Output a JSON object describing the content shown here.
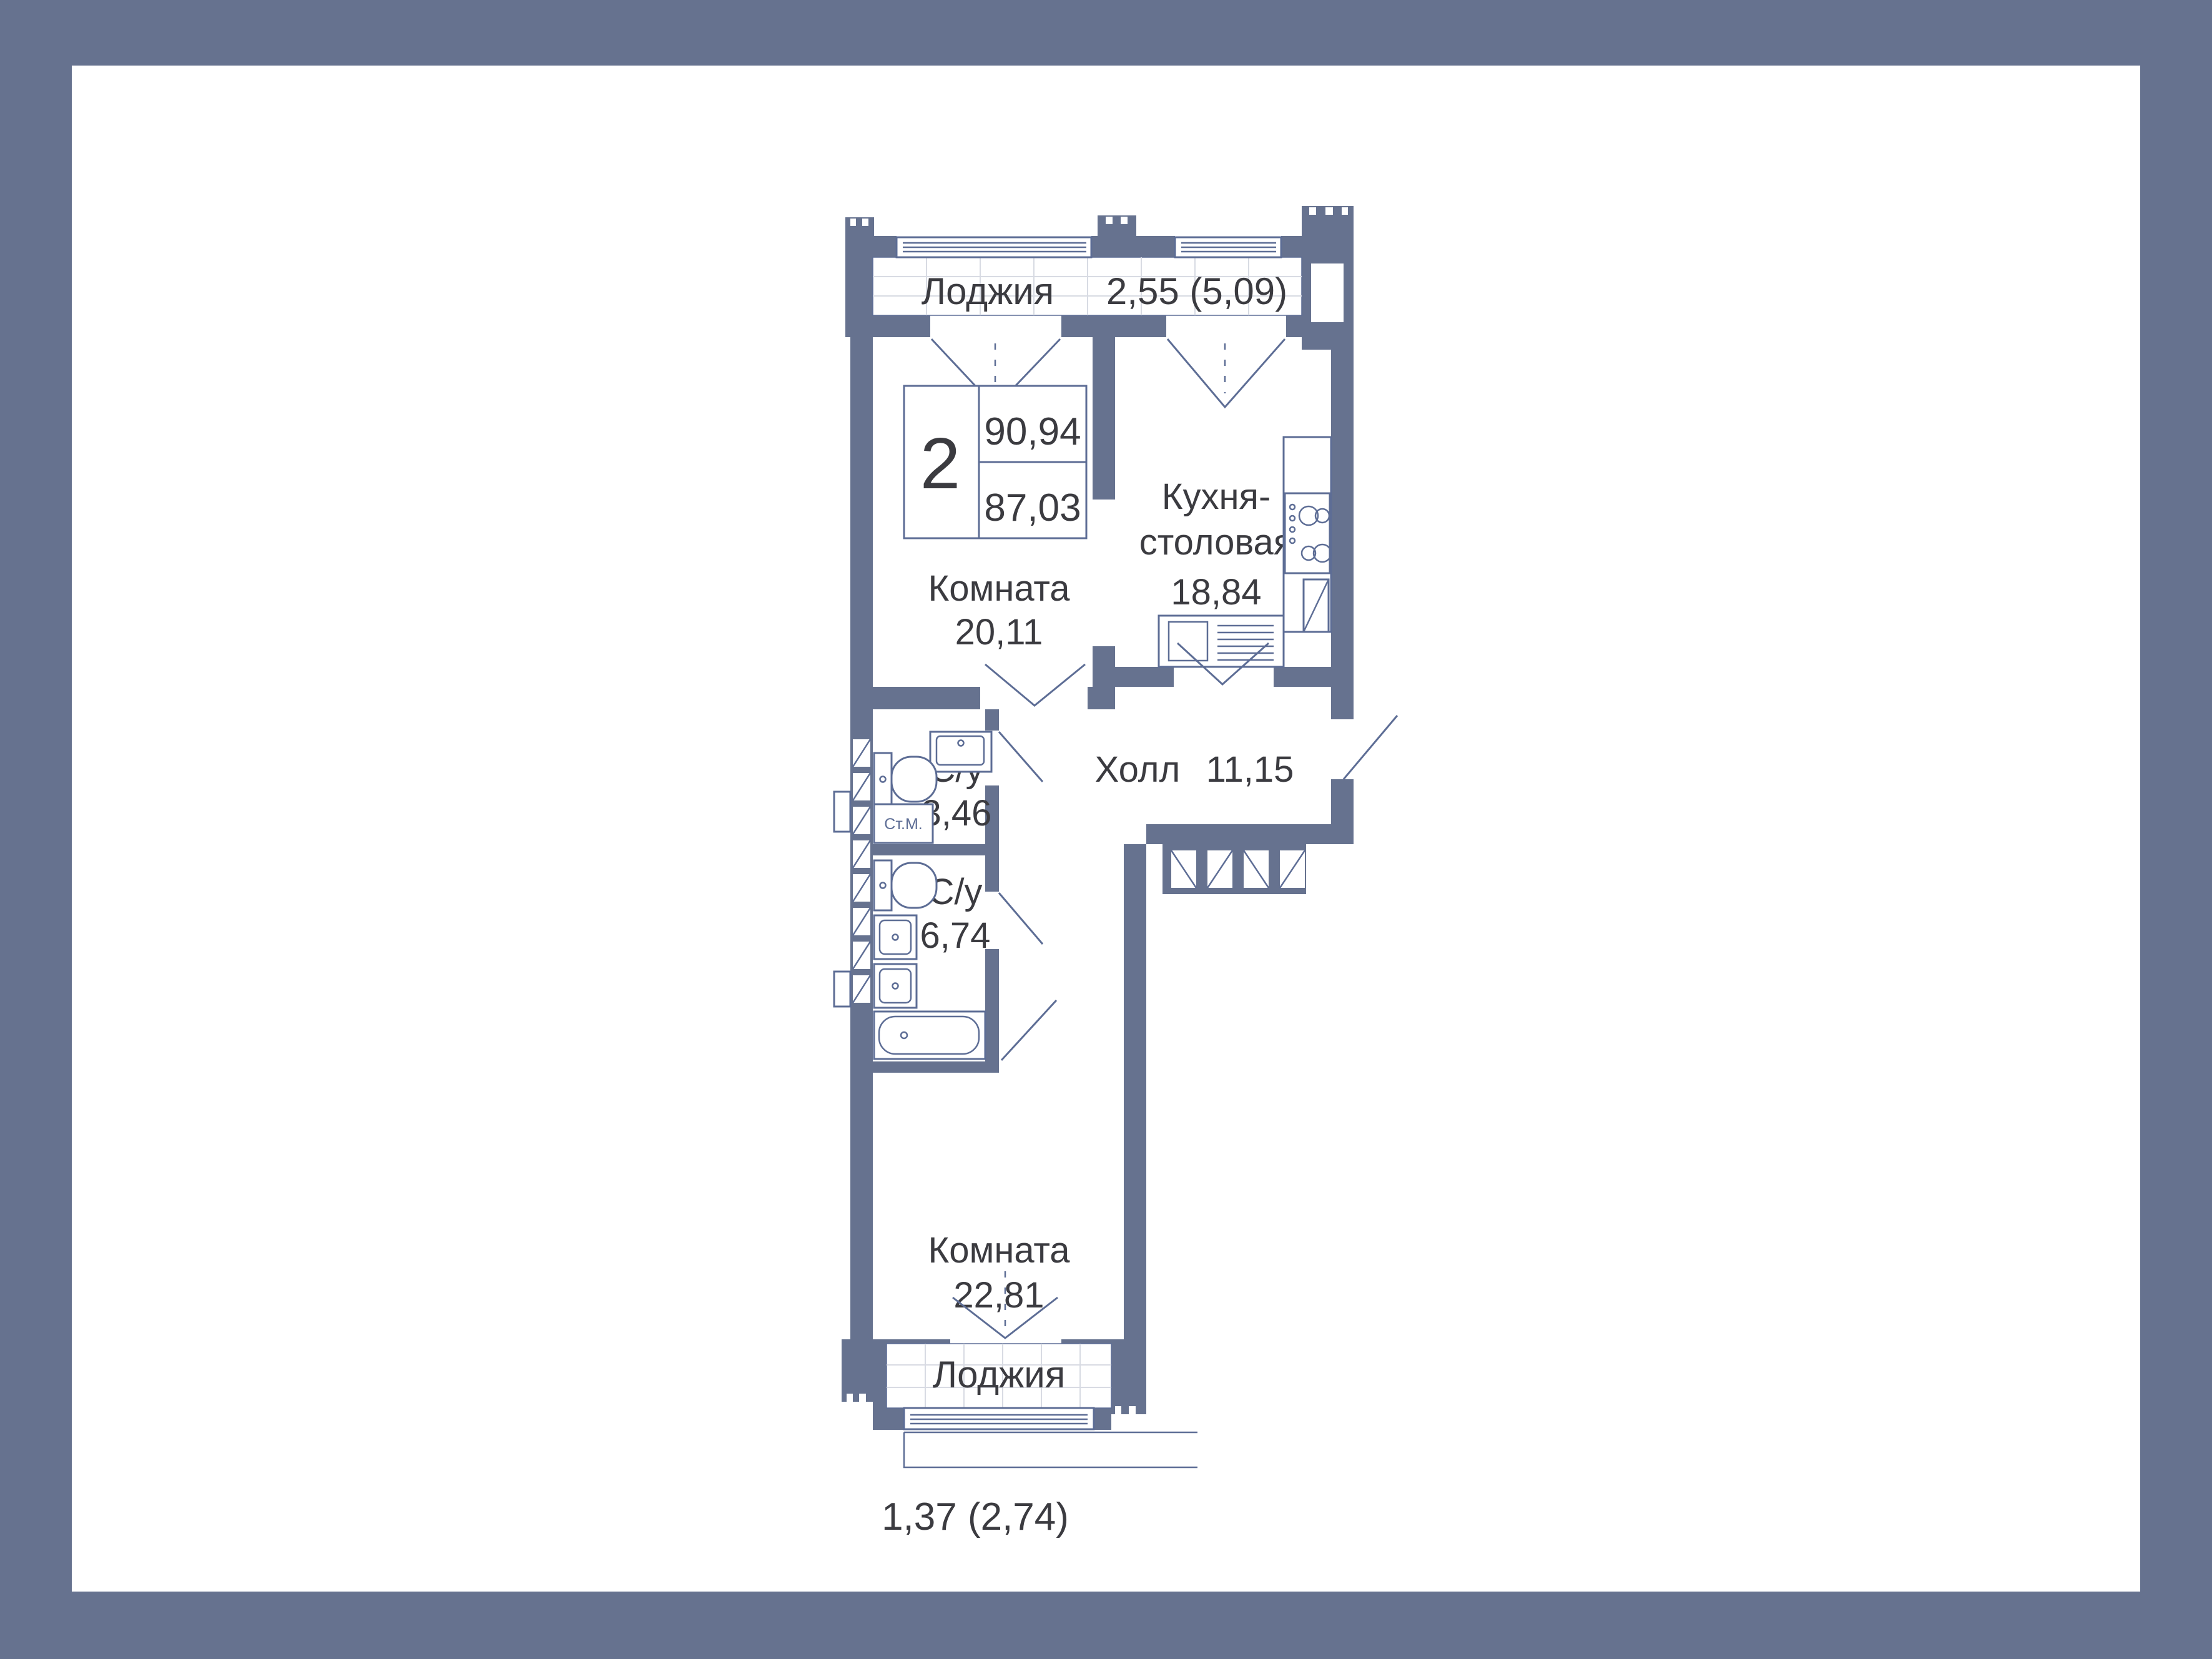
{
  "plan": {
    "loggia_top": {
      "label": "Лоджия",
      "area": "2,55 (5,09)"
    },
    "info_box": {
      "rooms": "2",
      "area_total": "90,94",
      "area_living": "87,03"
    },
    "room_top": {
      "label": "Комната",
      "area": "20,11"
    },
    "kitchen": {
      "label_line1": "Кухня-",
      "label_line2": "столовая",
      "area": "18,84"
    },
    "hall": {
      "label": "Холл",
      "area": "11,15"
    },
    "bathroom_small": {
      "label": "С/у",
      "area": "3,46"
    },
    "washing_machine": {
      "label": "Ст.М."
    },
    "bathroom_large": {
      "label": "С/у",
      "area": "6,74"
    },
    "room_bottom": {
      "label": "Комната",
      "area": "22,81"
    },
    "loggia_bottom": {
      "label": "Лоджия",
      "area": "1,37 (2,74)"
    },
    "colors": {
      "frame": "#66728F",
      "wall": "#66728F",
      "fixture_line": "#5D6D95",
      "text": "#3B3B40",
      "grid": "#D8DBE3",
      "background": "#FFFFFF"
    }
  }
}
